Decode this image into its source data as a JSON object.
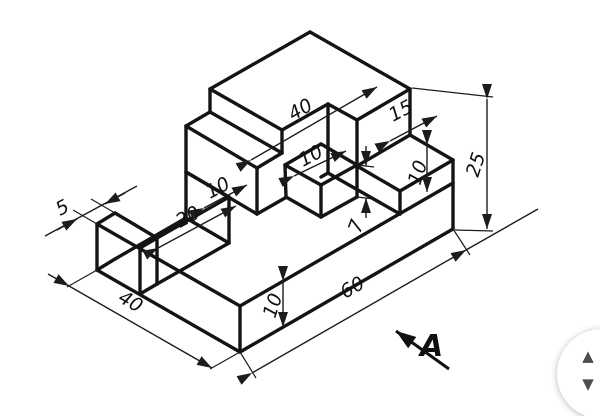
{
  "drawing": {
    "title": "isometric-part-drawing",
    "line_color": "#141414",
    "background": "#ffffff",
    "dimensions": {
      "wall_top_length": "40",
      "wall_step_width": "15",
      "total_height": "25",
      "wall_right_step_height": "10",
      "block_top_width": "10",
      "block_height": "7",
      "wall_left_step_width": "10",
      "slot_width": "20",
      "tab_width": "5",
      "base_depth": "40",
      "base_thickness": "10",
      "base_length": "60"
    },
    "view_arrow": {
      "label": "A"
    }
  },
  "scroll_widget": {
    "up_icon": "▲",
    "down_icon": "▼",
    "color": "#4d4d4d"
  }
}
